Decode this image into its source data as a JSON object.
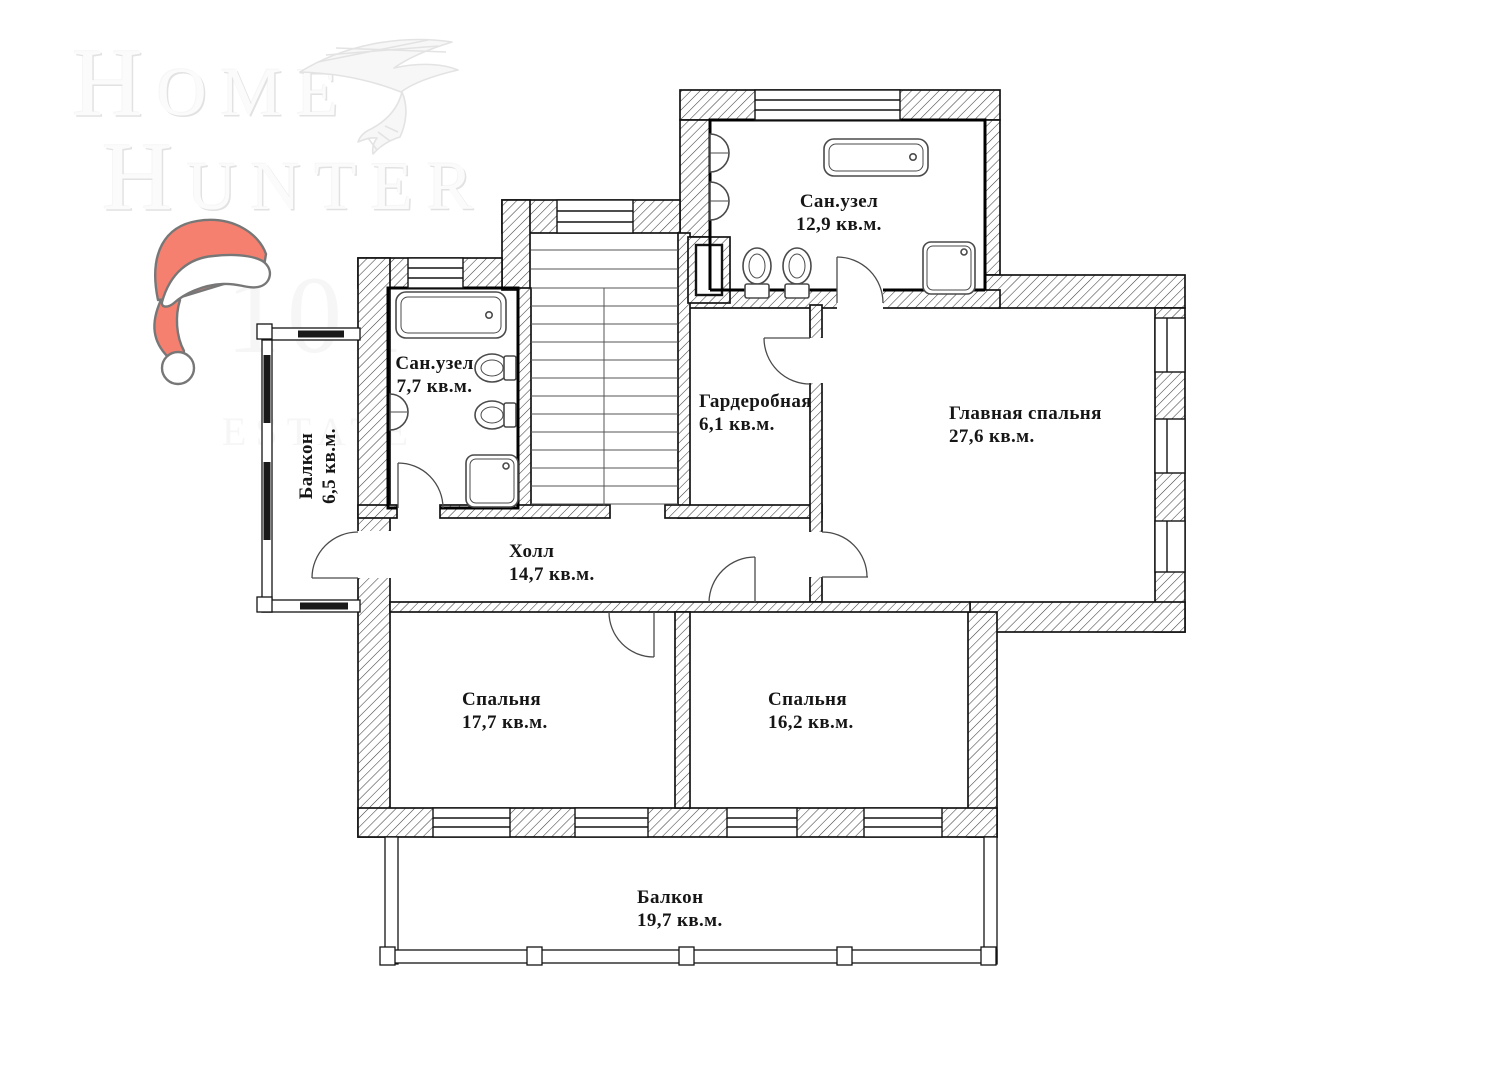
{
  "watermark": {
    "brand_line1": "Home",
    "brand_line2": "Hunter",
    "estate_number": "101",
    "estate_label": "ESTATE"
  },
  "rooms": [
    {
      "id": "bathroom-top",
      "name": "Сан.узел",
      "area": "12,9 кв.м."
    },
    {
      "id": "bathroom-left",
      "name": "Сан.узел",
      "area": "7,7 кв.м."
    },
    {
      "id": "wardrobe",
      "name": "Гардеробная",
      "area": "6,1 кв.м."
    },
    {
      "id": "master-bedroom",
      "name": "Главная спальня",
      "area": "27,6 кв.м."
    },
    {
      "id": "balcony-left",
      "name": "Балкон",
      "area": "6,5 кв.м."
    },
    {
      "id": "hall",
      "name": "Холл",
      "area": "14,7 кв.м."
    },
    {
      "id": "bedroom-left",
      "name": "Спальня",
      "area": "17,7 кв.м."
    },
    {
      "id": "bedroom-right",
      "name": "Спальня",
      "area": "16,2 кв.м."
    },
    {
      "id": "balcony-bottom",
      "name": "Балкон",
      "area": "19,7 кв.м."
    }
  ],
  "colors": {
    "santa_hat_red": "#f5806f",
    "hat_outline": "#777777",
    "wall_hatch": "#3f3f3f",
    "wall_outline": "#141414",
    "watermark_gray": "#e9e9e9"
  },
  "icons": {
    "eagle": "eagle-watermark-icon",
    "santa_hat": "santa-hat-icon"
  }
}
